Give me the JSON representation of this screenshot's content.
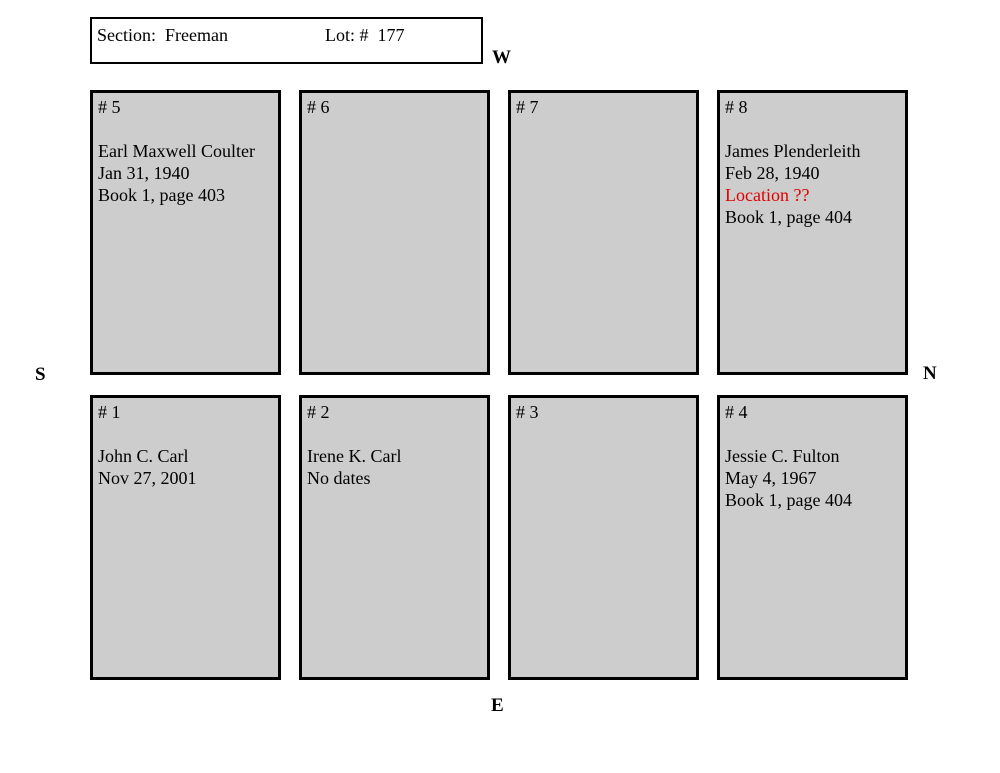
{
  "header_box": {
    "section_label": "Section:  Freeman",
    "lot_label": "Lot: #  177"
  },
  "compass": {
    "west": "W",
    "north": "N",
    "south": "S",
    "east": "E"
  },
  "colors": {
    "plot_fill": "#cdcdcd",
    "plot_border": "#000000",
    "alert_text": "#e00000"
  },
  "plots": [
    {
      "number": "# 5",
      "lines": [
        {
          "text": "Earl Maxwell Coulter"
        },
        {
          "text": "Jan 31, 1940"
        },
        {
          "text": "Book 1, page 403"
        }
      ]
    },
    {
      "number": "# 6",
      "lines": []
    },
    {
      "number": "# 7",
      "lines": []
    },
    {
      "number": "# 8",
      "lines": [
        {
          "text": "James Plenderleith"
        },
        {
          "text": "Feb 28, 1940"
        },
        {
          "text": "Location ??",
          "color": "#e00000"
        },
        {
          "text": "Book 1, page 404"
        }
      ]
    },
    {
      "number": "# 1",
      "lines": [
        {
          "text": "John C. Carl"
        },
        {
          "text": "Nov 27, 2001"
        }
      ]
    },
    {
      "number": "# 2",
      "lines": [
        {
          "text": "Irene K. Carl"
        },
        {
          "text": "No dates"
        }
      ]
    },
    {
      "number": "# 3",
      "lines": []
    },
    {
      "number": "# 4",
      "lines": [
        {
          "text": "Jessie C. Fulton"
        },
        {
          "text": "May 4, 1967"
        },
        {
          "text": "Book 1, page 404"
        }
      ]
    }
  ]
}
